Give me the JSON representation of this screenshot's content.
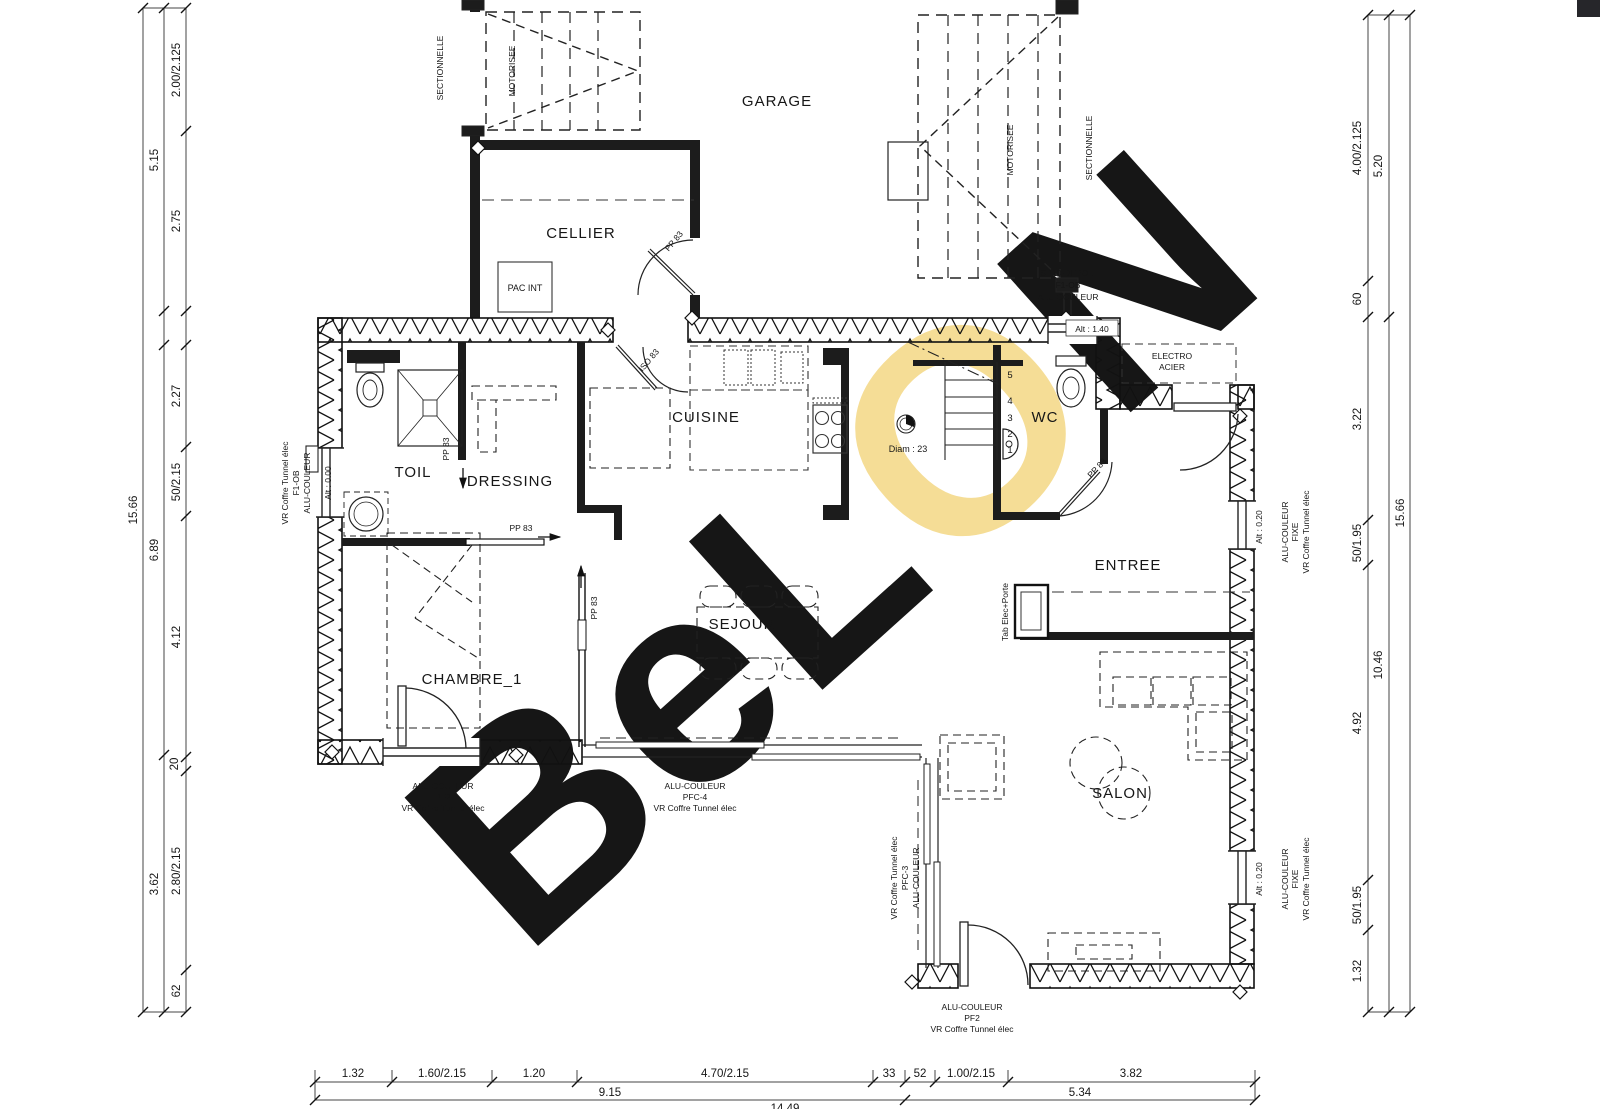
{
  "watermark": {
    "part1": "BeL",
    "part2": "O",
    "part3": "N",
    "gray": "#d8d8d8",
    "yellow": "#f5dd96"
  },
  "rooms": {
    "garage": "GARAGE",
    "cellier": "CELLIER",
    "cuisine": "CUISINE",
    "wc": "WC",
    "toil": "TOIL",
    "dressing": "DRESSING",
    "entree": "ENTREE",
    "sejour": "SEJOUR",
    "chambre": "CHAMBRE_1",
    "salon": "SALON"
  },
  "ann": {
    "pac": "PAC INT",
    "sectionnelle": "SECTIONNELLE",
    "motorisee": "MOTORISEE",
    "sp10": "SP10-DEPOLI",
    "f1ob": "F1-OB",
    "alu": "ALU-COULEUR",
    "alt140": "Alt : 1.40",
    "alt000": "Alt : 0.00",
    "alt020": "Alt : 0.20",
    "electro_l1": "ELECTRO",
    "electro_l2": "ACIER",
    "diam": "Diam : 23",
    "pp83": "PP 83",
    "iso83": "ISO 83",
    "tab": "Tab Elec+Porte",
    "vr": "VR Coffre Tunnel élec",
    "fixe": "FIXE",
    "pf2": "PF2",
    "pfc3": "PFC-3",
    "pfc4": "PFC-4"
  },
  "stairs": {
    "s5": "5",
    "s4": "4",
    "s3": "3",
    "s2": "2",
    "s1": "1"
  },
  "dims": {
    "left_inner": [
      "2.00/2.125",
      "2.75",
      "2.27",
      "50/2.15",
      "4.12",
      "20",
      "2.80/2.15",
      "62"
    ],
    "left_mid": [
      "5.15",
      "6.89",
      "3.62"
    ],
    "left_outer": "15.66",
    "right_inner": [
      "4.00/2.125",
      "60",
      "3.22",
      "50/1.95",
      "4.92",
      "50/1.95",
      "1.32"
    ],
    "right_mid": [
      "5.20",
      "10.46"
    ],
    "right_outer": "15.66",
    "bottom_r1": [
      "1.32",
      "1.60/2.15",
      "1.20",
      "4.70/2.15",
      "33",
      "52",
      "1.00/2.15",
      "3.82"
    ],
    "bottom_r2": [
      "9.15",
      "5.34"
    ],
    "bottom_r3": "14.49"
  }
}
